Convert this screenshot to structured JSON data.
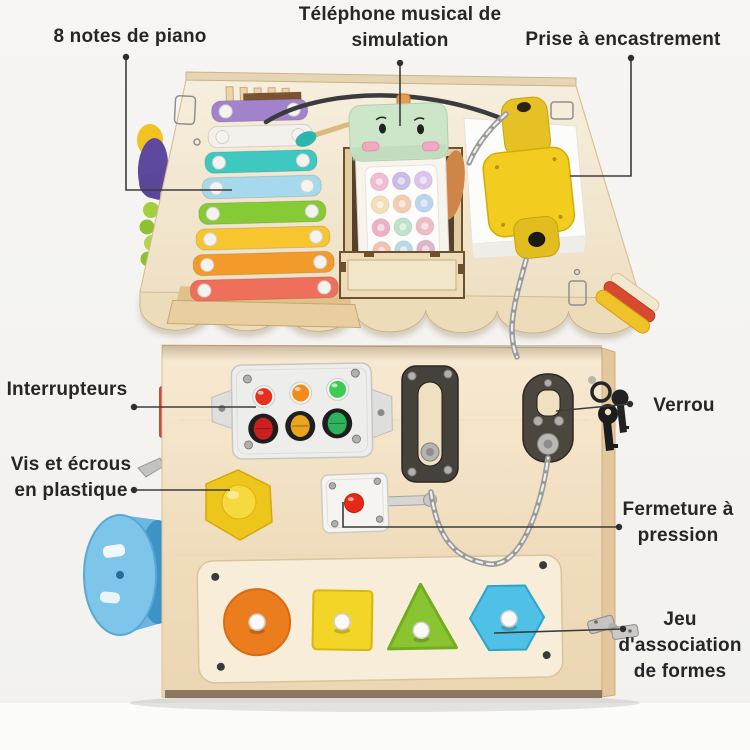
{
  "page": {
    "background_color": "#f5f4f2",
    "subject": "wooden busy-house activity cube with annotated features"
  },
  "labels": {
    "piano": {
      "text": "8 notes de piano"
    },
    "phone": {
      "text": "Téléphone musical de simulation"
    },
    "socket": {
      "text": "Prise à encastrement"
    },
    "switches": {
      "text": "Interrupteurs"
    },
    "screws": {
      "text": "Vis et écrous en plastique"
    },
    "lock": {
      "text": "Verrou"
    },
    "press_latch": {
      "text": "Fermeture à pression"
    },
    "shapes": {
      "text": "Jeu d'association de formes"
    }
  },
  "toy": {
    "xylophone": {
      "bar_count": 8,
      "bar_colors": [
        "#a183cd",
        "#f4f1ec",
        "#3fc8c0",
        "#a6d9ec",
        "#86ca36",
        "#f7c52e",
        "#f39b2a",
        "#ef6f5d"
      ]
    },
    "phone": {
      "head_color": "#cde6c9",
      "button_colors": [
        "#f2bcd2",
        "#cbbce8",
        "#dcc4ee",
        "#f4e0b8",
        "#f4ccb0",
        "#bcd4f0",
        "#eeb0c6",
        "#bce4cc",
        "#f0bcc4",
        "#f2c2b2",
        "#b4dce6",
        "#dcb4cc"
      ]
    },
    "socket": {
      "color": "#f2cd1f"
    },
    "switch_panel": {
      "light_colors": [
        "#e53020",
        "#f58a1a",
        "#3ecb52"
      ],
      "rocker_colors": [
        "#cc2020",
        "#eaa41e",
        "#2eb35e"
      ]
    },
    "press_latch": {
      "button_color": "#e52b18"
    },
    "hex_nut": {
      "color": "#eec51b"
    },
    "wheel": {
      "color": "#7ec5ea"
    },
    "shape_board": {
      "shapes": [
        {
          "name": "circle",
          "color": "#ec7d1e"
        },
        {
          "name": "square",
          "color": "#f2d526"
        },
        {
          "name": "triangle",
          "color": "#8ac432"
        },
        {
          "name": "hexagon",
          "color": "#4fc0e6"
        }
      ]
    }
  }
}
